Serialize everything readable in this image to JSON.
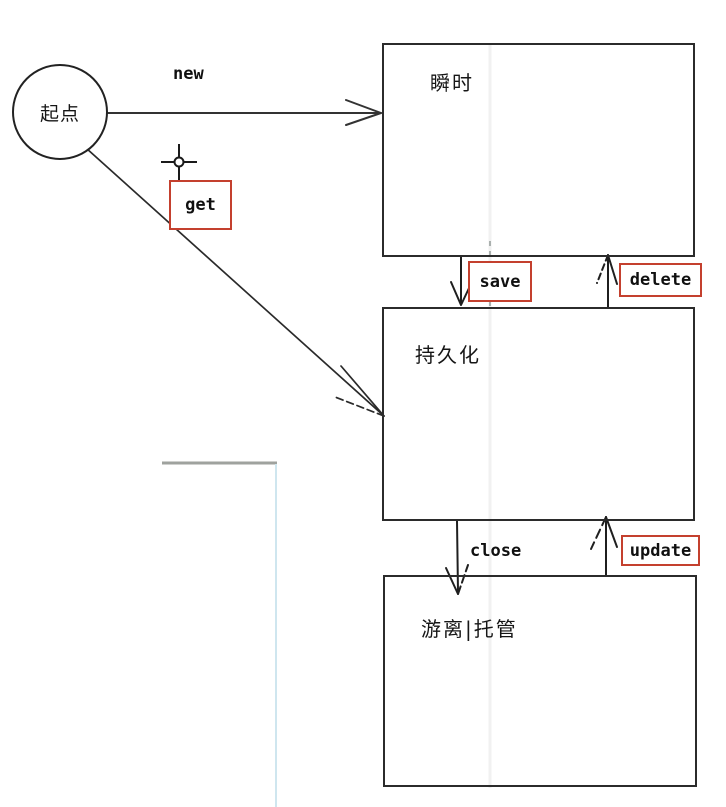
{
  "diagram": {
    "start": {
      "label": "起点"
    },
    "states": {
      "transient": {
        "label": "瞬时"
      },
      "persistent": {
        "label": "持久化"
      },
      "detached": {
        "label": "游离|托管"
      }
    },
    "transitions": {
      "new": {
        "label": "new",
        "boxed": false,
        "from": "start",
        "to": "transient"
      },
      "get": {
        "label": "get",
        "boxed": true,
        "from": "start",
        "to": "persistent"
      },
      "save": {
        "label": "save",
        "boxed": true,
        "from": "transient",
        "to": "persistent"
      },
      "delete": {
        "label": "delete",
        "boxed": true,
        "from": "persistent",
        "to": "transient"
      },
      "close": {
        "label": "close",
        "boxed": false,
        "from": "persistent",
        "to": "detached"
      },
      "update": {
        "label": "update",
        "boxed": true,
        "from": "detached",
        "to": "persistent"
      }
    },
    "cursor": {
      "type": "crosshair"
    },
    "colors": {
      "label_box_border": "#c4402e",
      "connector_line": "#333333",
      "state_border": "#2b2b2b",
      "stray_line_gray": "#9fa29e",
      "stray_line_blue": "#cfe6ef"
    }
  }
}
